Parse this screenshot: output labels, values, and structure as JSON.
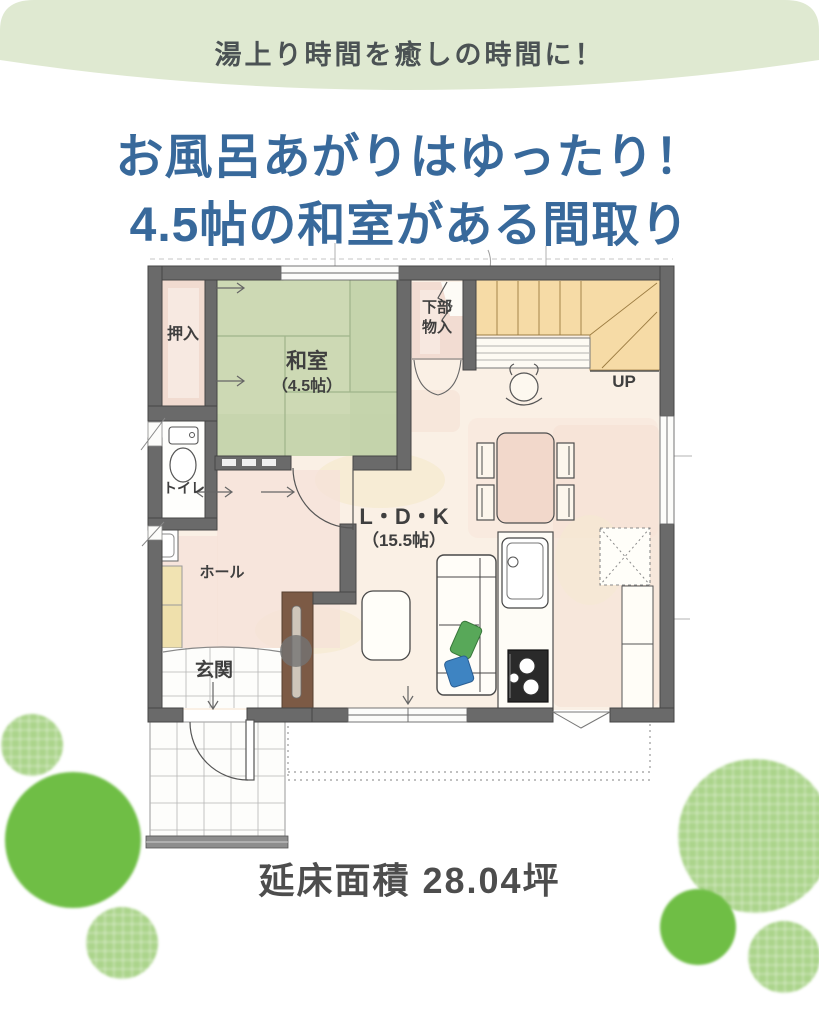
{
  "banner": {
    "text": "湯上り時間を癒しの時間に！",
    "bg_color": "#dfe9d1",
    "text_color": "#4b5254"
  },
  "heading": {
    "line1": "お風呂あがりはゆったり！",
    "line2": "4.5帖の和室がある間取り",
    "color": "#38699b"
  },
  "floorplan": {
    "rooms": {
      "oshiire": {
        "label": "押入"
      },
      "washitsu": {
        "label": "和室",
        "size": "（4.5帖）"
      },
      "toilet": {
        "label": "トイレ"
      },
      "hall": {
        "label": "ホール"
      },
      "genkan": {
        "label": "玄関"
      },
      "under_stairs": {
        "line1": "下部",
        "line2": "物入"
      },
      "ldk": {
        "label": "L・D・K",
        "size": "（15.5帖）"
      },
      "stairs": {
        "up_label": "UP"
      }
    },
    "colors": {
      "wall": "#6a6a6a",
      "floor": "#faf0e5",
      "tatami_green": "#cdd9b4",
      "closet_pink": "#f1dbd0",
      "stairs_tan": "#f6dba6",
      "hall_pink": "#f5e2d8",
      "tv_board_brown": "#7c5a45",
      "dining_table_pink": "#f2d8cb",
      "shoe_cabinet_cream": "#f1e3b2"
    }
  },
  "footer": {
    "area_label": "延床面積 28.04坪"
  },
  "decor": {
    "tree_solid_color": "#6fbe45",
    "tree_light_color": "#abd48b"
  }
}
